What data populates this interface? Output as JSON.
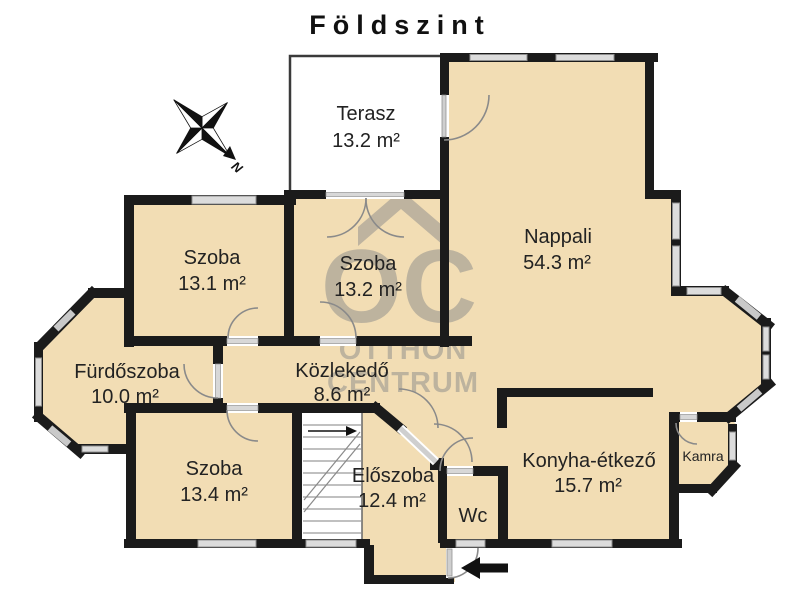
{
  "title": "Földszint",
  "compass": {
    "north_label": "N"
  },
  "watermark": {
    "logo": "OC",
    "line1": "OTTHON",
    "line2": "CENTRUM"
  },
  "rooms": {
    "terasz": {
      "name": "Terasz",
      "area": "13.2 m²"
    },
    "nappali": {
      "name": "Nappali",
      "area": "54.3 m²"
    },
    "szoba_131": {
      "name": "Szoba",
      "area": "13.1 m²"
    },
    "szoba_132": {
      "name": "Szoba",
      "area": "13.2 m²"
    },
    "furdoszoba": {
      "name": "Fürdőszoba",
      "area": "10.0 m²"
    },
    "kozlekedo": {
      "name": "Közlekedő",
      "area": "8.6 m²"
    },
    "szoba_134": {
      "name": "Szoba",
      "area": "13.4 m²"
    },
    "eloszoba": {
      "name": "Előszoba",
      "area": "12.4 m²"
    },
    "konyha": {
      "name": "Konyha-étkező",
      "area": "15.7 m²"
    },
    "wc": {
      "name": "Wc"
    },
    "kamra": {
      "name": "Kamra"
    }
  },
  "colors": {
    "floor": "#f2ddb4",
    "wall": "#1b1b1b",
    "window": "#dcdcdc",
    "terrace": "#ffffff",
    "watermark": "#8a8a8a"
  }
}
